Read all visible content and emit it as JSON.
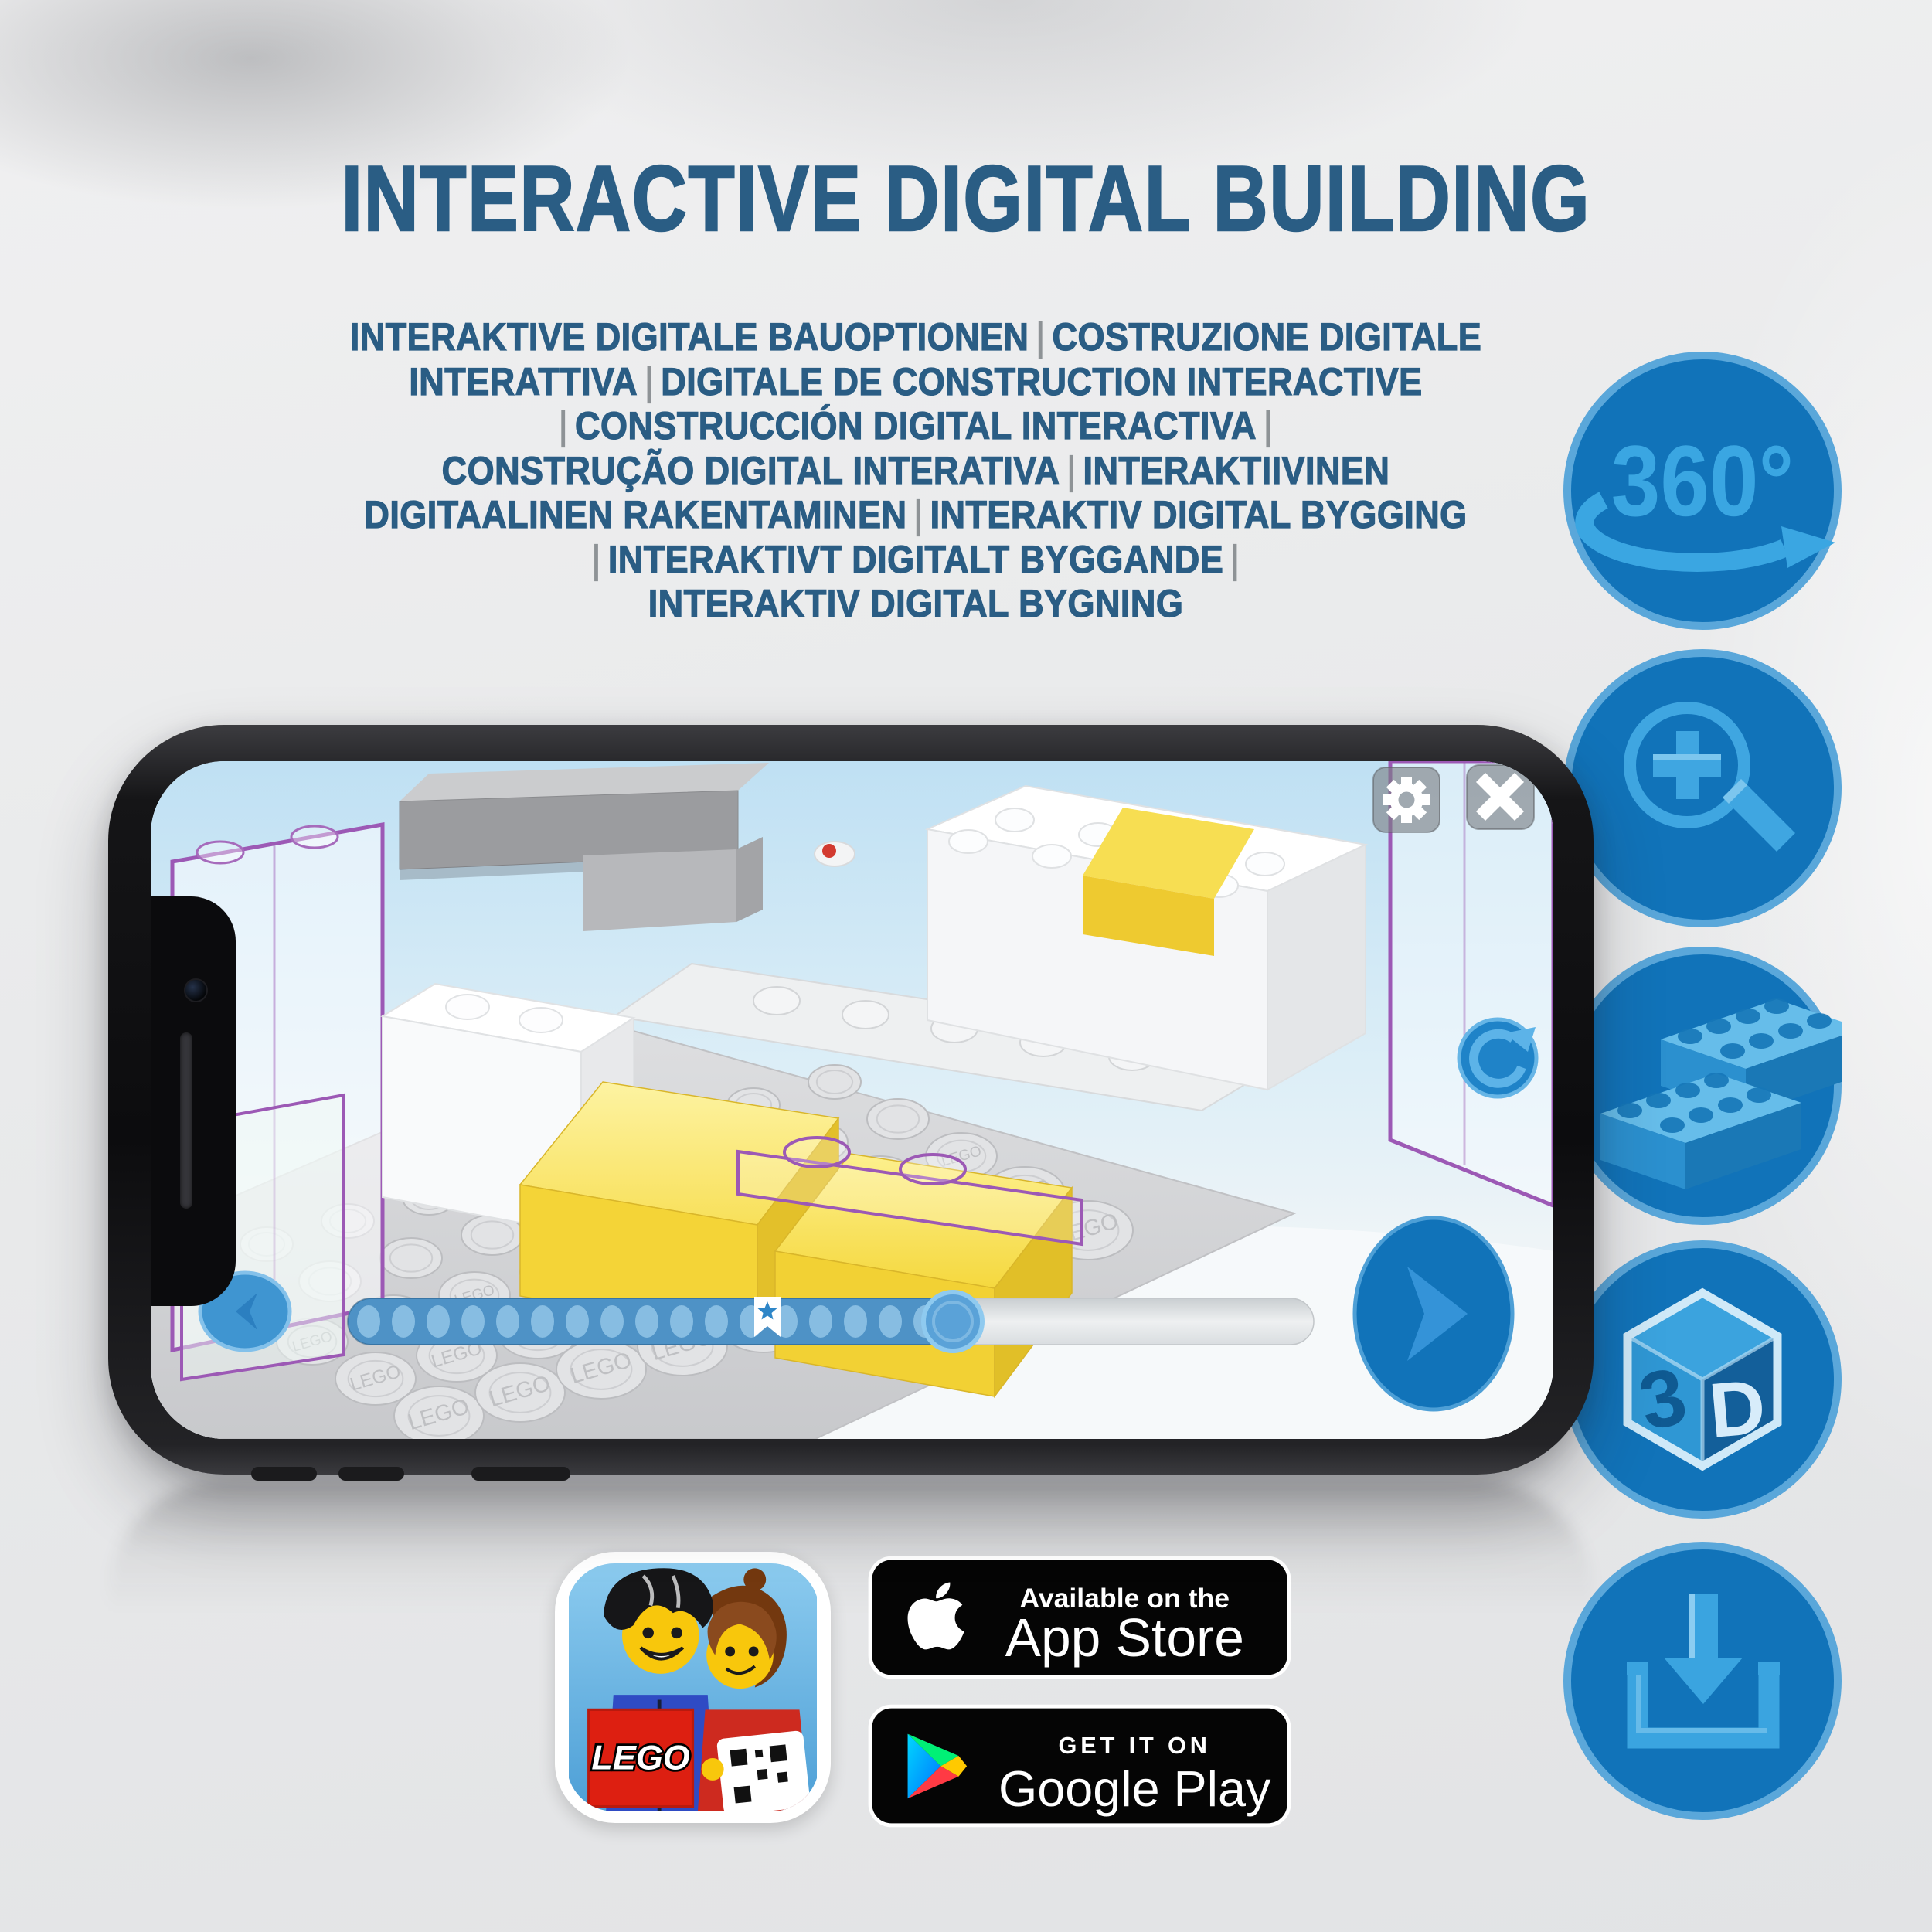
{
  "title": "INTERACTIVE DIGITAL BUILDING",
  "subtitle": {
    "lines": [
      "INTERAKTIVE DIGITALE BAUOPTIONEN | COSTRUZIONE DIGITALE",
      "INTERATTIVA | DIGITALE DE CONSTRUCTION INTERACTIVE",
      "| CONSTRUCCIÓN DIGITAL INTERACTIVA |",
      "CONSTRUÇÃO DIGITAL INTERATIVA | INTERAKTIIVINEN",
      "DIGITAALINEN RAKENTAMINEN | INTERAKTIV DIGITAL BYGGING",
      "| INTERAKTIVT DIGITALT BYGGANDE |",
      "INTERAKTIV DIGITAL BYGNING"
    ],
    "separator_color": "#8e9396"
  },
  "features": [
    {
      "id": "rotation-360",
      "label": "360°"
    },
    {
      "id": "zoom-in",
      "label": ""
    },
    {
      "id": "brick-building-options",
      "label": ""
    },
    {
      "id": "view-3d",
      "left_face": "3",
      "right_face": "D"
    },
    {
      "id": "download",
      "label": ""
    }
  ],
  "phone": {
    "screen_ui": {
      "top_buttons": [
        {
          "name": "settings",
          "icon": "gear-icon"
        },
        {
          "name": "close",
          "icon": "close-icon"
        }
      ],
      "rotate_button_icon": "rotate-cw-icon",
      "prev_button_icon": "chevron-left-icon",
      "next_button_icon": "chevron-right-icon",
      "progress": {
        "total_dots": 17,
        "filled_fraction": 0.63,
        "bookmark_fraction": 0.43,
        "bookmark_icon": "star-icon"
      },
      "stud_embossing": "LEGO"
    }
  },
  "store": {
    "app_icon_logo": "LEGO",
    "app_store": {
      "top_line": "Available on the",
      "name": "App Store"
    },
    "google_play": {
      "top_line": "GET IT ON",
      "name": "Google Play"
    }
  },
  "colors": {
    "accent_blue": "#1173b9",
    "ring_blue": "#5aa7da",
    "glyph_blue": "#3aa6e2",
    "heading_blue": "#2a5d84",
    "separator_gray": "#8e9396",
    "brick_yellow": "#f4d437",
    "ghost_outline_purple": "#9c59b5",
    "badge_black": "#050505"
  }
}
